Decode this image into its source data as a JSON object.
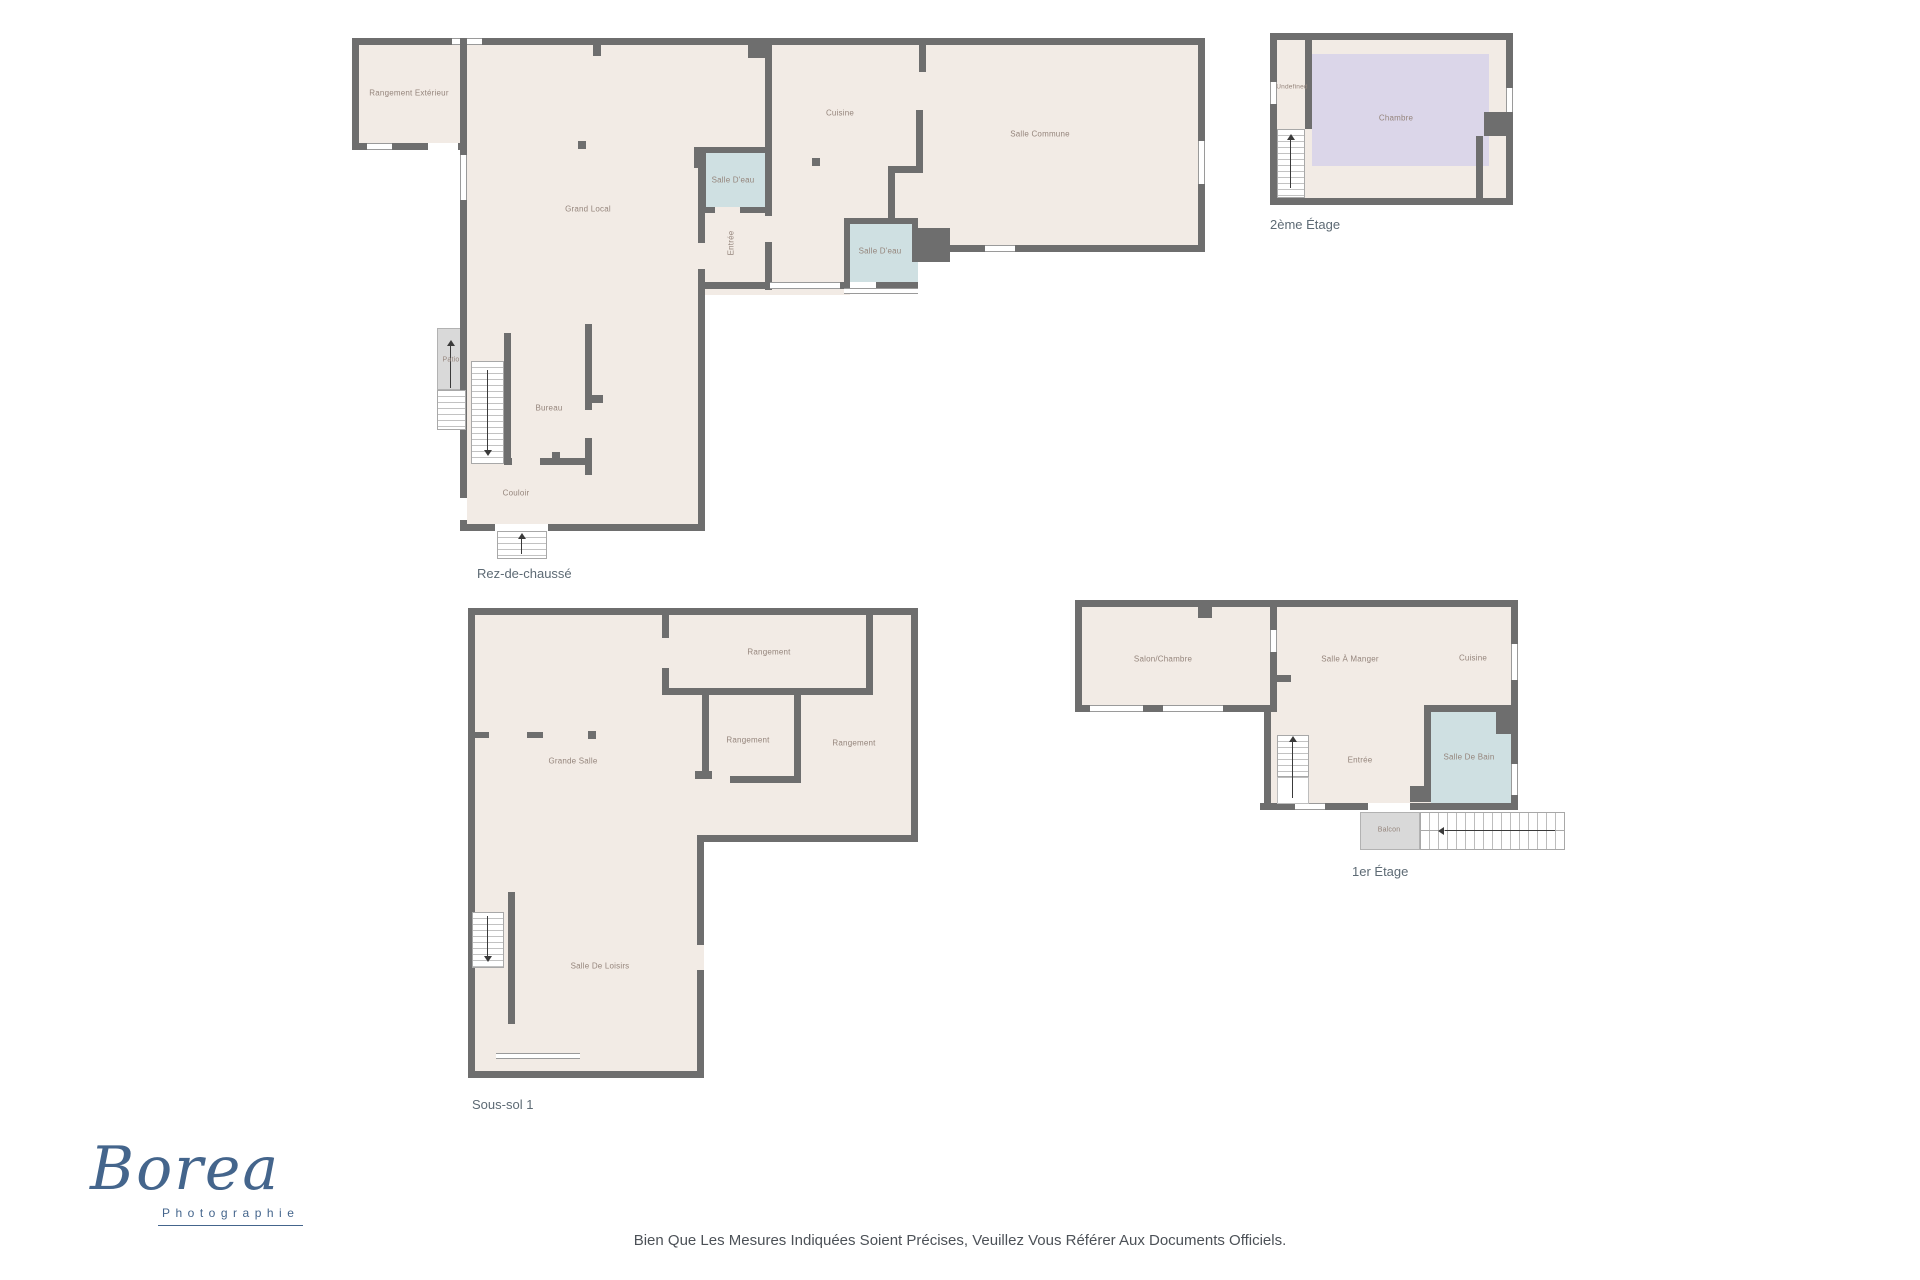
{
  "plans": {
    "rdc": {
      "caption": "Rez-de-chaussé",
      "rooms": {
        "rangement_exterieur": "Rangement Extérieur",
        "cuisine": "Cuisine",
        "salle_commune": "Salle Commune",
        "salle_deau_1": "Salle D'eau",
        "grand_local": "Grand Local",
        "entree": "Entrée",
        "salle_deau_2": "Salle D'eau",
        "patio": "Patio",
        "bureau": "Bureau",
        "couloir": "Couloir"
      }
    },
    "etage2": {
      "caption": "2ème Étage",
      "rooms": {
        "undefined_room": "Undefined",
        "chambre": "Chambre"
      }
    },
    "soussol": {
      "caption": "Sous-sol 1",
      "rooms": {
        "rangement_1": "Rangement",
        "rangement_2": "Rangement",
        "rangement_3": "Rangement",
        "grande_salle": "Grande Salle",
        "salle_de_loisirs": "Salle De Loisirs"
      }
    },
    "etage1": {
      "caption": "1er Étage",
      "rooms": {
        "salon_chambre": "Salon/Chambre",
        "salle_a_manger": "Salle À Manger",
        "cuisine": "Cuisine",
        "salle_de_bain": "Salle De Bain",
        "entree": "Entrée",
        "balcon": "Balcon"
      }
    }
  },
  "footer": {
    "logo": {
      "name": "Borea",
      "subtitle": "Photographie"
    },
    "disclaimer": "Bien Que Les Mesures Indiquées Soient Précises, Veuillez Vous Référer Aux Documents Officiels."
  },
  "colors": {
    "floor_fill": "#f2ebe5",
    "wall": "#6e6e6e",
    "wet_room_fill": "#cfe0e2",
    "bedroom_fill": "#dbd6e9",
    "outdoor_fill": "#d9d9d9",
    "label_text": "#95857c",
    "caption_text": "#5d6a74",
    "logo_blue": "#44658c"
  }
}
